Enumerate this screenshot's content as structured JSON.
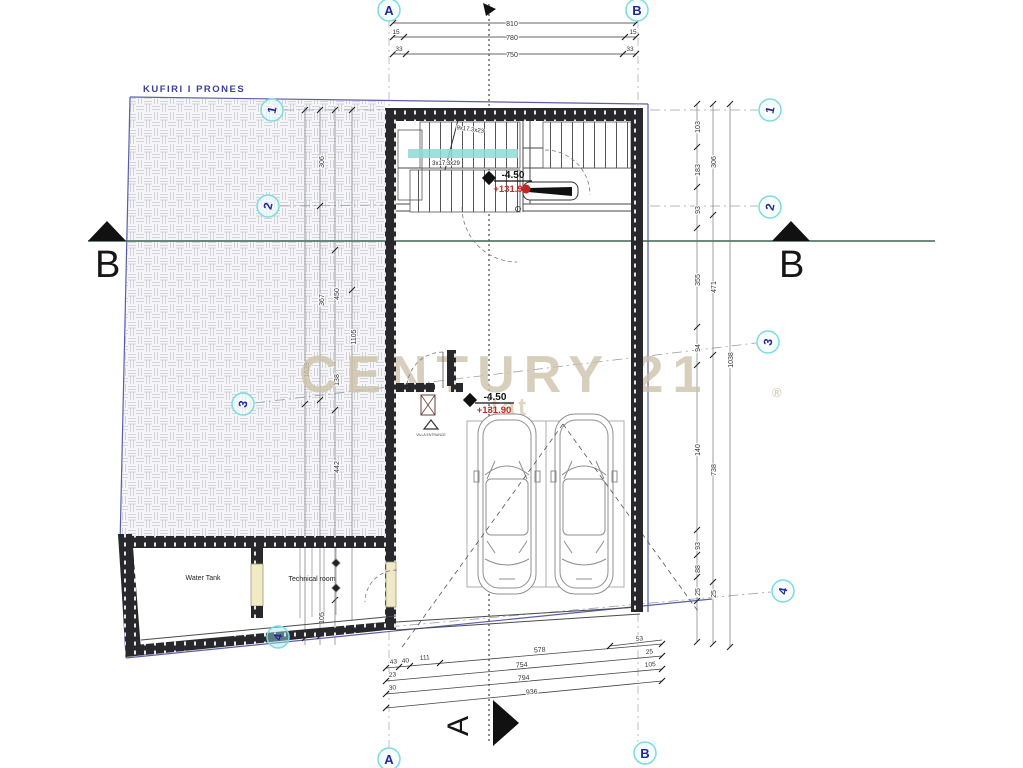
{
  "drawing": {
    "boundary_label": "KUFIRI I PRONES",
    "watermark": {
      "brand": "CENTURY 21",
      "reg": "®",
      "fragment": "tat"
    },
    "grid_bubbles": {
      "top_a": "A",
      "top_b": "B",
      "bottom_a": "A",
      "bottom_b": "B",
      "left": [
        "1",
        "2",
        "3",
        "4"
      ],
      "right": [
        "1",
        "2",
        "3",
        "4"
      ]
    },
    "section_markers": {
      "b_left": "B",
      "b_right": "B",
      "a_bottom": "A"
    },
    "levels": {
      "upper": {
        "depth": "-4.50",
        "elevation": "+131.9"
      },
      "lower": {
        "depth": "-4.50",
        "elevation": "+131.90"
      }
    },
    "stairs": {
      "flight_upper": "9x17.3x23",
      "flight_lower": "3x17.3x29"
    },
    "rooms": {
      "water_tank": "Water Tank",
      "technical_room": "Technical room",
      "entrance": "VILLA ENTRANCE"
    },
    "dimensions": {
      "top": {
        "total": "810",
        "side_a": "15",
        "middle": "780",
        "side_b": "15",
        "off_a": "33",
        "inner": "750",
        "off_b": "33"
      },
      "bottom": [
        "53",
        "43",
        "40",
        "111",
        "578",
        "23",
        "754",
        "25",
        "30",
        "794",
        "105",
        "936"
      ],
      "left": [
        "306",
        "367",
        "1639",
        "450",
        "138",
        "442",
        "1105",
        "105"
      ],
      "right": [
        "103",
        "183",
        "93",
        "355",
        "94",
        "140",
        "93",
        "88",
        "25",
        "306",
        "471",
        "738",
        "25",
        "1038"
      ]
    }
  }
}
